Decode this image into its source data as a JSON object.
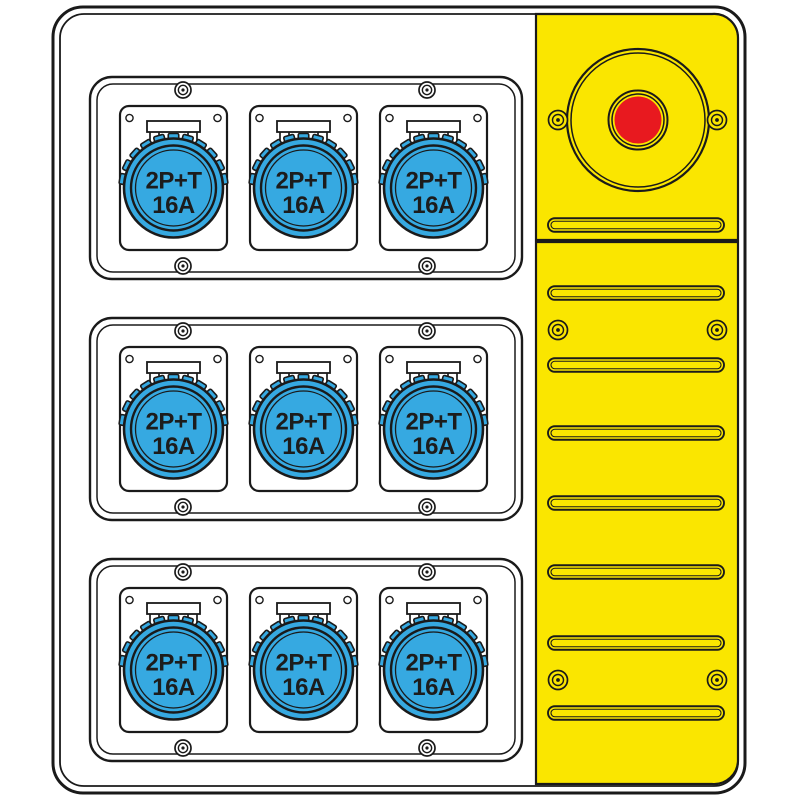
{
  "board": {
    "kind": "socket-distribution-board-drawing",
    "background_color": "#ffffff",
    "line_color": "#1a1a1a",
    "socket_modules": {
      "rows": 3,
      "sockets_per_row": 3,
      "socket_label_line1": "2P+T",
      "socket_label_line2": "16A",
      "socket_color": "#36a9e1",
      "plate_color": "#ffffff"
    },
    "side_panel": {
      "panel_color": "#fae600",
      "sections": 2,
      "emergency_button": {
        "button_color": "#e8191f",
        "icon": "emergency-stop-icon"
      },
      "vent_slot_count": 8,
      "screw_pair_count": 3
    }
  }
}
